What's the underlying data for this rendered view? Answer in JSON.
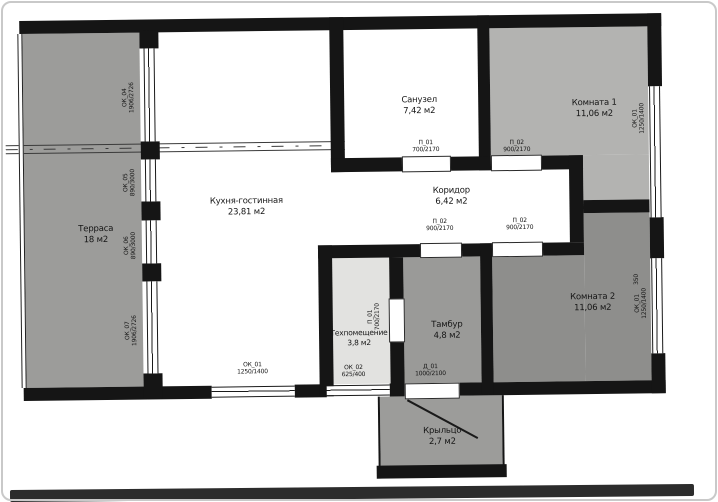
{
  "colors": {
    "wall": "#151515",
    "terrace_fill": "#9c9c9a",
    "room1_fill": "#b3b3b1",
    "room2_fill": "#8e8e8c",
    "tambour_fill": "#9a9a98",
    "tech_fill": "#e2e2e0",
    "porch_fill": "#9c9c9a",
    "white_room_fill": "#ffffff",
    "photo_border": "#c9c9c9",
    "photo_bottom_edge": "#2c2c2c"
  },
  "rooms": [
    {
      "id": "terrace",
      "name": "Терраса",
      "area": "18 м2"
    },
    {
      "id": "kitchen",
      "name": "Кухня-гостинная",
      "area": "23,81 м2"
    },
    {
      "id": "bathroom",
      "name": "Санузел",
      "area": "7,42 м2"
    },
    {
      "id": "corridor",
      "name": "Коридор",
      "area": "6,42 м2"
    },
    {
      "id": "room1",
      "name": "Комната 1",
      "area": "11,06 м2"
    },
    {
      "id": "room2",
      "name": "Комната 2",
      "area": "11,06 м2"
    },
    {
      "id": "tech",
      "name": "Техпомещение",
      "area": "3,8 м2"
    },
    {
      "id": "tambour",
      "name": "Тамбур",
      "area": "4,8 м2"
    },
    {
      "id": "porch",
      "name": "Крыльцо",
      "area": "2,7 м2"
    }
  ],
  "openings": [
    {
      "id": "ok04-left-wall",
      "code": "ОК_04",
      "size": "1906/2726"
    },
    {
      "id": "ok05-left-wall",
      "code": "ОК_05",
      "size": "890/3000"
    },
    {
      "id": "ok06-left-wall",
      "code": "ОК_06",
      "size": "890/3000"
    },
    {
      "id": "ok07-left-wall",
      "code": "ОК_07",
      "size": "1906/2726"
    },
    {
      "id": "ok01-bottom-wall",
      "code": "ОК_01",
      "size": "1250/1400"
    },
    {
      "id": "ok02-bottom-wall",
      "code": "ОК_02",
      "size": "625/400"
    },
    {
      "id": "d01-entrance-door",
      "code": "Д_01",
      "size": "1000/2100"
    },
    {
      "id": "p01-bathroom-door",
      "code": "П_01",
      "size": "700/2170"
    },
    {
      "id": "p02-room1-door",
      "code": "П_02",
      "size": "900/2170"
    },
    {
      "id": "p02-tambour-door",
      "code": "П_02",
      "size": "900/2170"
    },
    {
      "id": "p02-room2-door",
      "code": "П_02",
      "size": "900/2170"
    },
    {
      "id": "p01-tech-door",
      "code": "П_01",
      "size": "700/2170"
    },
    {
      "id": "ok01-right-wall-top",
      "code": "ОК_01",
      "size": "1250/1400"
    },
    {
      "id": "ok01-right-wall-bottom",
      "code": "ОК_01",
      "size": "1250/1400"
    }
  ],
  "annotations": {
    "dim_350": "350"
  }
}
